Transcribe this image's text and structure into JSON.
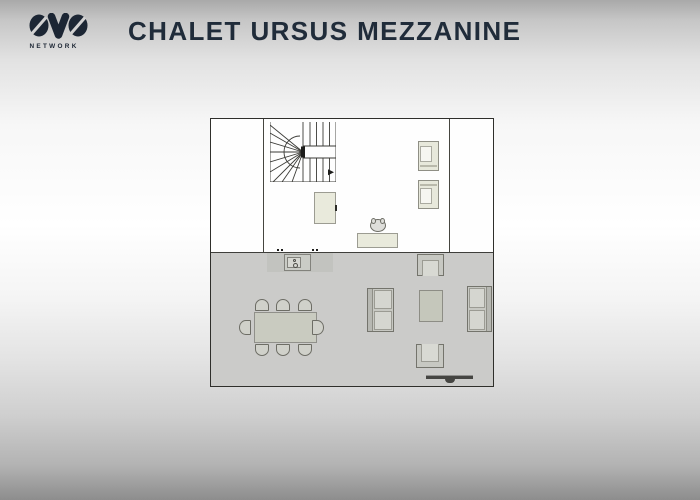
{
  "header": {
    "logo_text": "OVO",
    "logo_subtext": "NETWORK",
    "title": "CHALET URSUS MEZZANINE"
  },
  "colors": {
    "brand_dark": "#1c2634",
    "title_text": "#202c3a",
    "plan_border": "#2f2f2b",
    "upper_floor": "#fefefe",
    "lower_floor": "#cbcbc9",
    "cream_furniture": "#e9eadc",
    "gray_furniture": "#c9cbc0",
    "tv_dark": "#454542"
  },
  "plan": {
    "x": 210,
    "y": 118,
    "width": 284,
    "height": 269,
    "gray_region_top": 133,
    "furniture": [
      {
        "name": "mezzanine-wall-left",
        "type": "wall-v",
        "x": 52,
        "y": 0,
        "w": 1,
        "h": 133
      },
      {
        "name": "mezzanine-wall-right",
        "type": "wall-v",
        "x": 238,
        "y": 0,
        "w": 1,
        "h": 133
      },
      {
        "name": "staircase",
        "type": "stairs",
        "x": 59,
        "y": 3,
        "w": 66,
        "h": 60
      },
      {
        "name": "wardrobe",
        "type": "wardrobe",
        "x": 103,
        "y": 73,
        "w": 22,
        "h": 32
      },
      {
        "name": "desk",
        "type": "desk",
        "x": 146,
        "y": 114,
        "w": 41,
        "h": 15
      },
      {
        "name": "desk-chair",
        "type": "desk-chair",
        "x": 159,
        "y": 100,
        "w": 16,
        "h": 13
      },
      {
        "name": "lounge-chair-top",
        "type": "lounge-chair",
        "band": "s",
        "x": 207,
        "y": 22,
        "w": 21,
        "h": 30
      },
      {
        "name": "lounge-chair-bottom",
        "type": "lounge-chair",
        "band": "n",
        "x": 207,
        "y": 61,
        "w": 21,
        "h": 29
      },
      {
        "name": "kitchen-counter",
        "type": "counter",
        "x": 56,
        "y": 134,
        "w": 66,
        "h": 19
      },
      {
        "name": "kitchen-sink-unit",
        "type": "sink-unit",
        "x": 73,
        "y": 135,
        "w": 27,
        "h": 17
      },
      {
        "name": "wall-mark-1",
        "type": "dot",
        "x": 66,
        "y": 130,
        "w": 2,
        "h": 2
      },
      {
        "name": "wall-mark-2",
        "type": "dot",
        "x": 70,
        "y": 130,
        "w": 2,
        "h": 2
      },
      {
        "name": "wall-mark-3",
        "type": "dot",
        "x": 101,
        "y": 130,
        "w": 2,
        "h": 2
      },
      {
        "name": "wall-mark-4",
        "type": "dot",
        "x": 105,
        "y": 130,
        "w": 2,
        "h": 2
      },
      {
        "name": "dining-table",
        "type": "dining-table",
        "x": 43,
        "y": 193,
        "w": 63,
        "h": 31
      },
      {
        "name": "dining-chair-n1",
        "type": "chair",
        "dir": "n",
        "x": 44,
        "y": 180,
        "w": 14,
        "h": 12
      },
      {
        "name": "dining-chair-n2",
        "type": "chair",
        "dir": "n",
        "x": 65,
        "y": 180,
        "w": 14,
        "h": 12
      },
      {
        "name": "dining-chair-n3",
        "type": "chair",
        "dir": "n",
        "x": 87,
        "y": 180,
        "w": 14,
        "h": 12
      },
      {
        "name": "dining-chair-s1",
        "type": "chair",
        "dir": "s",
        "x": 44,
        "y": 225,
        "w": 14,
        "h": 12
      },
      {
        "name": "dining-chair-s2",
        "type": "chair",
        "dir": "s",
        "x": 65,
        "y": 225,
        "w": 14,
        "h": 12
      },
      {
        "name": "dining-chair-s3",
        "type": "chair",
        "dir": "s",
        "x": 87,
        "y": 225,
        "w": 14,
        "h": 12
      },
      {
        "name": "dining-chair-w",
        "type": "chair",
        "dir": "w",
        "x": 28,
        "y": 201,
        "w": 12,
        "h": 15
      },
      {
        "name": "dining-chair-e",
        "type": "chair",
        "dir": "e",
        "x": 101,
        "y": 201,
        "w": 12,
        "h": 15
      },
      {
        "name": "armchair-north",
        "type": "armchair",
        "dir": "n",
        "x": 206,
        "y": 135,
        "w": 27,
        "h": 22
      },
      {
        "name": "sofa-west",
        "type": "sofa",
        "dir": "w",
        "x": 156,
        "y": 169,
        "w": 27,
        "h": 44
      },
      {
        "name": "coffee-table",
        "type": "coffee-table",
        "x": 208,
        "y": 171,
        "w": 24,
        "h": 32
      },
      {
        "name": "sofa-east",
        "type": "sofa",
        "dir": "e",
        "x": 256,
        "y": 167,
        "w": 25,
        "h": 46
      },
      {
        "name": "armchair-south",
        "type": "armchair",
        "dir": "s",
        "x": 205,
        "y": 225,
        "w": 28,
        "h": 24
      },
      {
        "name": "tv",
        "type": "tv",
        "x": 215,
        "y": 256,
        "w": 47,
        "h": 4
      }
    ]
  }
}
